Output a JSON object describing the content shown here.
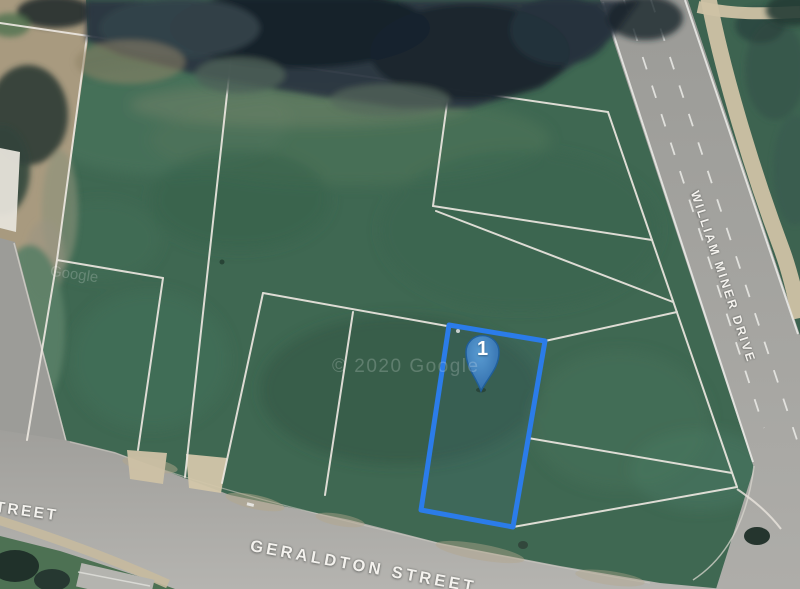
{
  "map": {
    "streets": {
      "geraldton": "GERALDTON STREET",
      "william_miner": "WILLIAM MINER DRIVE",
      "left_partial": "STREET"
    },
    "marker": {
      "label": "1"
    },
    "watermark": {
      "center": "© 2020 Google",
      "left": "Google"
    },
    "highlight_lot": {
      "stroke": "#2b7ce9"
    },
    "colors": {
      "field_green": "#3f6852",
      "road_gray": "#a4a4a0",
      "parcel_line": "#ece7e0",
      "path_beige": "#cfc2a5",
      "marker_fill": "#5b9fd8",
      "marker_stroke": "#1f5f9e"
    }
  }
}
